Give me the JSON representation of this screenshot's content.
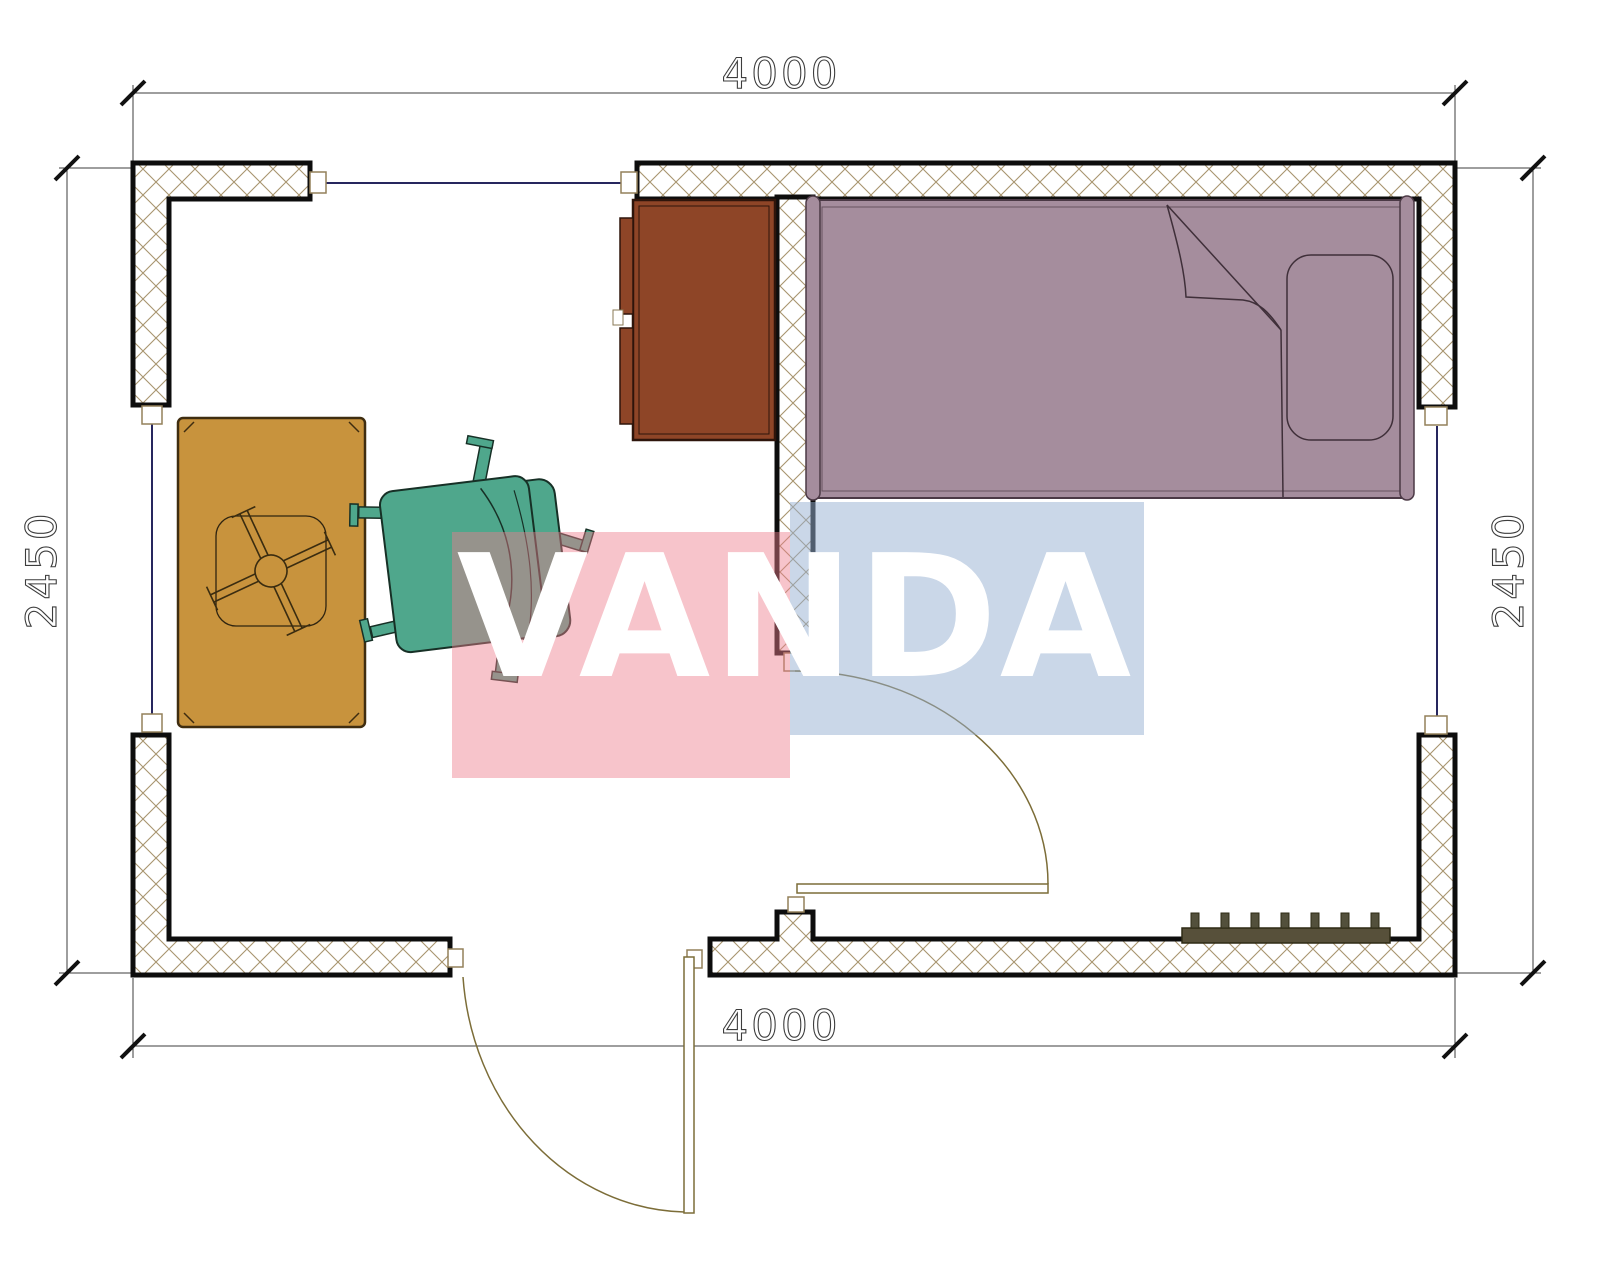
{
  "drawing": {
    "title_text": "",
    "dimensions": {
      "top": "4000",
      "bottom": "4000",
      "left": "2450",
      "right": "2450"
    },
    "watermark": {
      "text": "VANDA",
      "pink_block_color": "#ee7d8c",
      "blue_block_color": "#96afd2",
      "text_color": "#ffffff"
    },
    "colors": {
      "bed": "#a58d9d",
      "bed_outline": "#4b3945",
      "cabinet": "#8e4527",
      "cabinet_outline": "#2e150b",
      "desk": "#c8933d",
      "desk_outline": "#3f2d10",
      "chair": "#4fa78c",
      "chair_outline": "#173026",
      "radiator": "#57503a",
      "wall_hatch": "#a8946e",
      "wall_border": "#0d0d0d",
      "opening_line": "#26265e",
      "door_line": "#7c6d38",
      "dimension_line": "#3d3d3d"
    },
    "symbols": [
      "bed-symbol",
      "pillow-symbol",
      "wardrobe-symbol",
      "desk-symbol",
      "office-chair-symbol",
      "radiator-symbol",
      "door-swing-symbol",
      "window-symbol"
    ]
  }
}
